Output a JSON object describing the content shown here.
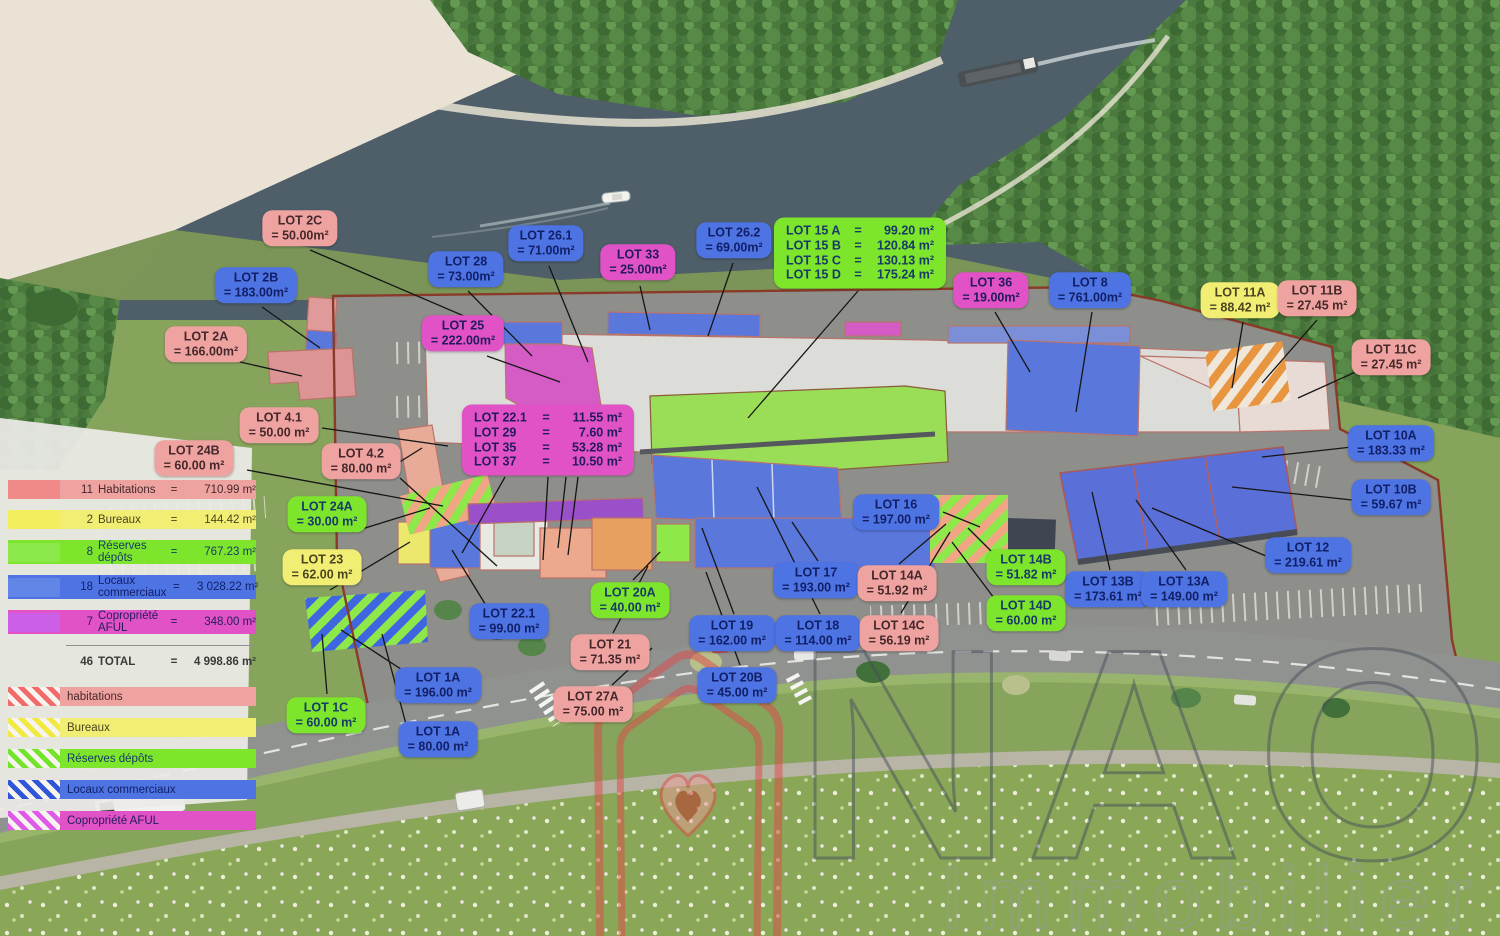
{
  "title": "Plan de masse — lots commerciaux",
  "legend": {
    "rows": [
      {
        "count": "11",
        "label": "Habitations",
        "eq": "=",
        "value": "710.99 m²",
        "category": "habitation"
      },
      {
        "count": "2",
        "label": "Bureaux",
        "eq": "=",
        "value": "144.42 m²",
        "category": "bureau"
      },
      {
        "count": "8",
        "label": "Réserves dépôts",
        "eq": "=",
        "value": "767.23 m²",
        "category": "reserve"
      },
      {
        "count": "18",
        "label": "Locaux commerciaux",
        "eq": "=",
        "value": "3 028.22 m²",
        "category": "commercial"
      },
      {
        "count": "7",
        "label": "Copropriété AFUL",
        "eq": "=",
        "value": "348.00 m²",
        "category": "aful"
      }
    ],
    "total": {
      "count": "46",
      "label": "TOTAL",
      "eq": "=",
      "value": "4 998.86 m²"
    },
    "hatches": [
      {
        "label": "habitations",
        "category": "habitation"
      },
      {
        "label": "Bureaux",
        "category": "bureau"
      },
      {
        "label": "Réserves dépôts",
        "category": "reserve"
      },
      {
        "label": "Locaux commerciaux",
        "category": "commercial"
      },
      {
        "label": "Copropriété AFUL",
        "category": "aful"
      }
    ]
  },
  "labels": [
    {
      "id": "2c",
      "name": "LOT 2C",
      "area": "= 50.00m²",
      "category": "habitation",
      "x": 300,
      "y": 228
    },
    {
      "id": "2b",
      "name": "LOT 2B",
      "area": "= 183.00m²",
      "category": "commercial",
      "x": 256,
      "y": 285
    },
    {
      "id": "2a",
      "name": "LOT 2A",
      "area": "= 166.00m²",
      "category": "habitation",
      "x": 206,
      "y": 344
    },
    {
      "id": "28",
      "name": "LOT 28",
      "area": "= 73.00m²",
      "category": "commercial",
      "x": 466,
      "y": 269
    },
    {
      "id": "26-1",
      "name": "LOT 26.1",
      "area": "= 71.00m²",
      "category": "commercial",
      "x": 546,
      "y": 243
    },
    {
      "id": "33",
      "name": "LOT 33",
      "area": "= 25.00m²",
      "category": "aful",
      "x": 638,
      "y": 262
    },
    {
      "id": "26-2",
      "name": "LOT 26.2",
      "area": "= 69.00m²",
      "category": "commercial",
      "x": 734,
      "y": 240
    },
    {
      "id": "36",
      "name": "LOT 36",
      "area": "= 19.00m²",
      "category": "aful",
      "x": 991,
      "y": 290
    },
    {
      "id": "8",
      "name": "LOT 8",
      "area": "= 761.00m²",
      "category": "commercial",
      "x": 1090,
      "y": 290
    },
    {
      "id": "11a",
      "name": "LOT 11A",
      "area": "= 88.42 m²",
      "category": "bureau",
      "x": 1240,
      "y": 300
    },
    {
      "id": "11b",
      "name": "LOT 11B",
      "area": "= 27.45 m²",
      "category": "habitation",
      "x": 1317,
      "y": 298
    },
    {
      "id": "11c",
      "name": "LOT 11C",
      "area": "= 27.45 m²",
      "category": "habitation",
      "x": 1391,
      "y": 357
    },
    {
      "id": "25",
      "name": "LOT 25",
      "area": "= 222.00m²",
      "category": "aful",
      "x": 463,
      "y": 333
    },
    {
      "id": "4-1",
      "name": "LOT 4.1",
      "area": "= 50.00 m²",
      "category": "habitation",
      "x": 279,
      "y": 425
    },
    {
      "id": "24b",
      "name": "LOT 24B",
      "area": "= 60.00 m²",
      "category": "habitation",
      "x": 194,
      "y": 458
    },
    {
      "id": "4-2",
      "name": "LOT 4.2",
      "area": "= 80.00 m²",
      "category": "habitation",
      "x": 361,
      "y": 461
    },
    {
      "id": "24a",
      "name": "LOT 24A",
      "area": "= 30.00 m²",
      "category": "reserve",
      "x": 327,
      "y": 514
    },
    {
      "id": "23",
      "name": "LOT 23",
      "area": "= 62.00 m²",
      "category": "bureau",
      "x": 322,
      "y": 567
    },
    {
      "id": "22-1",
      "name": "LOT 22.1",
      "area": "= 99.00 m²",
      "category": "commercial",
      "x": 509,
      "y": 621
    },
    {
      "id": "16",
      "name": "LOT 16",
      "area": "= 197.00 m²",
      "category": "commercial",
      "x": 896,
      "y": 512
    },
    {
      "id": "10a",
      "name": "LOT 10A",
      "area": "= 183.33 m²",
      "category": "commercial",
      "x": 1391,
      "y": 443
    },
    {
      "id": "10b",
      "name": "LOT 10B",
      "area": "= 59.67 m²",
      "category": "commercial",
      "x": 1391,
      "y": 497
    },
    {
      "id": "12",
      "name": "LOT 12",
      "area": "= 219.61 m²",
      "category": "commercial",
      "x": 1308,
      "y": 555
    },
    {
      "id": "13b",
      "name": "LOT 13B",
      "area": "= 173.61 m²",
      "category": "commercial",
      "x": 1108,
      "y": 589
    },
    {
      "id": "13a",
      "name": "LOT 13A",
      "area": "= 149.00 m²",
      "category": "commercial",
      "x": 1184,
      "y": 589
    },
    {
      "id": "14b",
      "name": "LOT 14B",
      "area": "= 51.82 m²",
      "category": "reserve",
      "x": 1026,
      "y": 567
    },
    {
      "id": "14d",
      "name": "LOT 14D",
      "area": "= 60.00 m²",
      "category": "reserve",
      "x": 1026,
      "y": 613
    },
    {
      "id": "17",
      "name": "LOT 17",
      "area": "= 193.00 m²",
      "category": "commercial",
      "x": 816,
      "y": 580
    },
    {
      "id": "14a",
      "name": "LOT 14A",
      "area": "= 51.92 m²",
      "category": "habitation",
      "x": 897,
      "y": 583
    },
    {
      "id": "20a",
      "name": "LOT 20A",
      "area": "= 40.00 m²",
      "category": "reserve",
      "x": 630,
      "y": 600
    },
    {
      "id": "19",
      "name": "LOT 19",
      "area": "= 162.00 m²",
      "category": "commercial",
      "x": 732,
      "y": 633
    },
    {
      "id": "18",
      "name": "LOT 18",
      "area": "= 114.00 m²",
      "category": "commercial",
      "x": 818,
      "y": 633
    },
    {
      "id": "14c",
      "name": "LOT 14C",
      "area": "= 56.19 m²",
      "category": "habitation",
      "x": 899,
      "y": 633
    },
    {
      "id": "21",
      "name": "LOT 21",
      "area": "= 71.35 m²",
      "category": "habitation",
      "x": 610,
      "y": 652
    },
    {
      "id": "20b",
      "name": "LOT 20B",
      "area": "= 45.00 m²",
      "category": "commercial",
      "x": 737,
      "y": 685
    },
    {
      "id": "27a",
      "name": "LOT 27A",
      "area": "= 75.00 m²",
      "category": "habitation",
      "x": 593,
      "y": 704
    },
    {
      "id": "1a-196",
      "name": "LOT 1A",
      "area": "= 196.00 m²",
      "category": "commercial",
      "x": 438,
      "y": 685
    },
    {
      "id": "1c",
      "name": "LOT 1C",
      "area": "= 60.00 m²",
      "category": "reserve",
      "x": 326,
      "y": 715
    },
    {
      "id": "1a-80",
      "name": "LOT 1A",
      "area": "= 80.00 m²",
      "category": "commercial",
      "x": 438,
      "y": 739
    }
  ],
  "multi": {
    "lot15": {
      "eq": "=",
      "rows": [
        {
          "name": "LOT 15 A",
          "value": "99.20 m²"
        },
        {
          "name": "LOT 15 B",
          "value": "120.84 m²"
        },
        {
          "name": "LOT 15 C",
          "value": "130.13 m²"
        },
        {
          "name": "LOT 15 D",
          "value": "175.24 m²"
        }
      ]
    },
    "lot22": {
      "eq": "=",
      "rows": [
        {
          "name": "LOT 22.1",
          "value": "11.55 m²"
        },
        {
          "name": "LOT 29",
          "value": "7.60 m²"
        },
        {
          "name": "LOT 35",
          "value": "53.28 m²"
        },
        {
          "name": "LOT 37",
          "value": "10.50 m²"
        }
      ]
    }
  },
  "watermark": {
    "brand": "NAOS",
    "subtitle": "Immobilier"
  },
  "colors": {
    "water": "#4e5f69",
    "sand": "#eae3d5",
    "forest": "#4c7a3e",
    "grass": "#87a45c",
    "site": "#8e8e8a",
    "roof": "#dcdcda",
    "boundary": "#8a3a28",
    "road": "#909290",
    "habitation": "#efa3a0",
    "bureau": "#f2ee74",
    "reserve": "#7de52c",
    "commercial": "#4e73e3",
    "aful": "#e052c6",
    "watermark_red": "#e04848"
  }
}
